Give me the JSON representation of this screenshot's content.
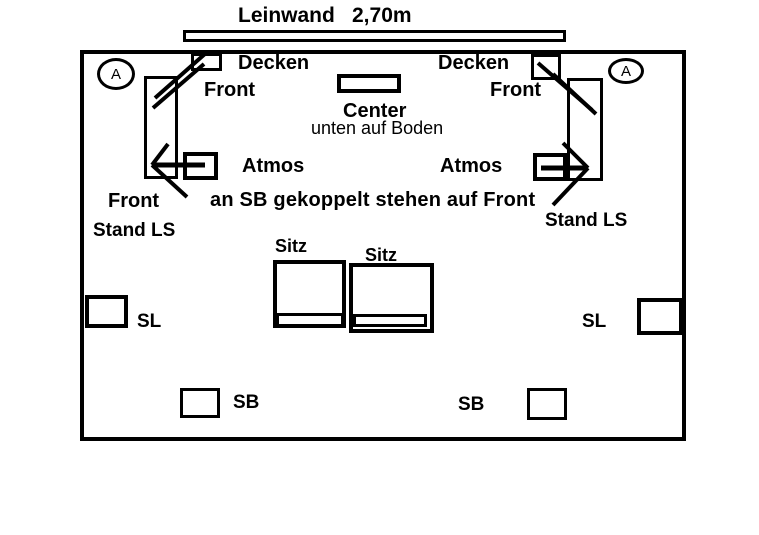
{
  "background_color": "#ffffff",
  "ink_color": "#000000",
  "screen": {
    "label": "Leinwand",
    "width_label": "2,70m"
  },
  "room": {
    "corner_markers": {
      "left": "A",
      "right": "A"
    },
    "ceiling_speakers": {
      "left_label": "Decken",
      "right_label": "Decken"
    },
    "front_top": {
      "left_label": "Front",
      "right_label": "Front"
    },
    "center": {
      "label": "Center",
      "note": "unten auf Boden"
    },
    "atmos": {
      "left_label": "Atmos",
      "right_label": "Atmos",
      "note": "an SB gekoppelt stehen auf Front"
    },
    "front_stand": {
      "left_label": "Front",
      "left_sub": "Stand LS",
      "right_sub": "Stand LS"
    },
    "seats": {
      "left_label": "Sitz",
      "right_label": "Sitz"
    },
    "surround": {
      "left_label": "SL",
      "right_label": "SL"
    },
    "surround_back": {
      "left_label": "SB",
      "right_label": "SB"
    }
  }
}
